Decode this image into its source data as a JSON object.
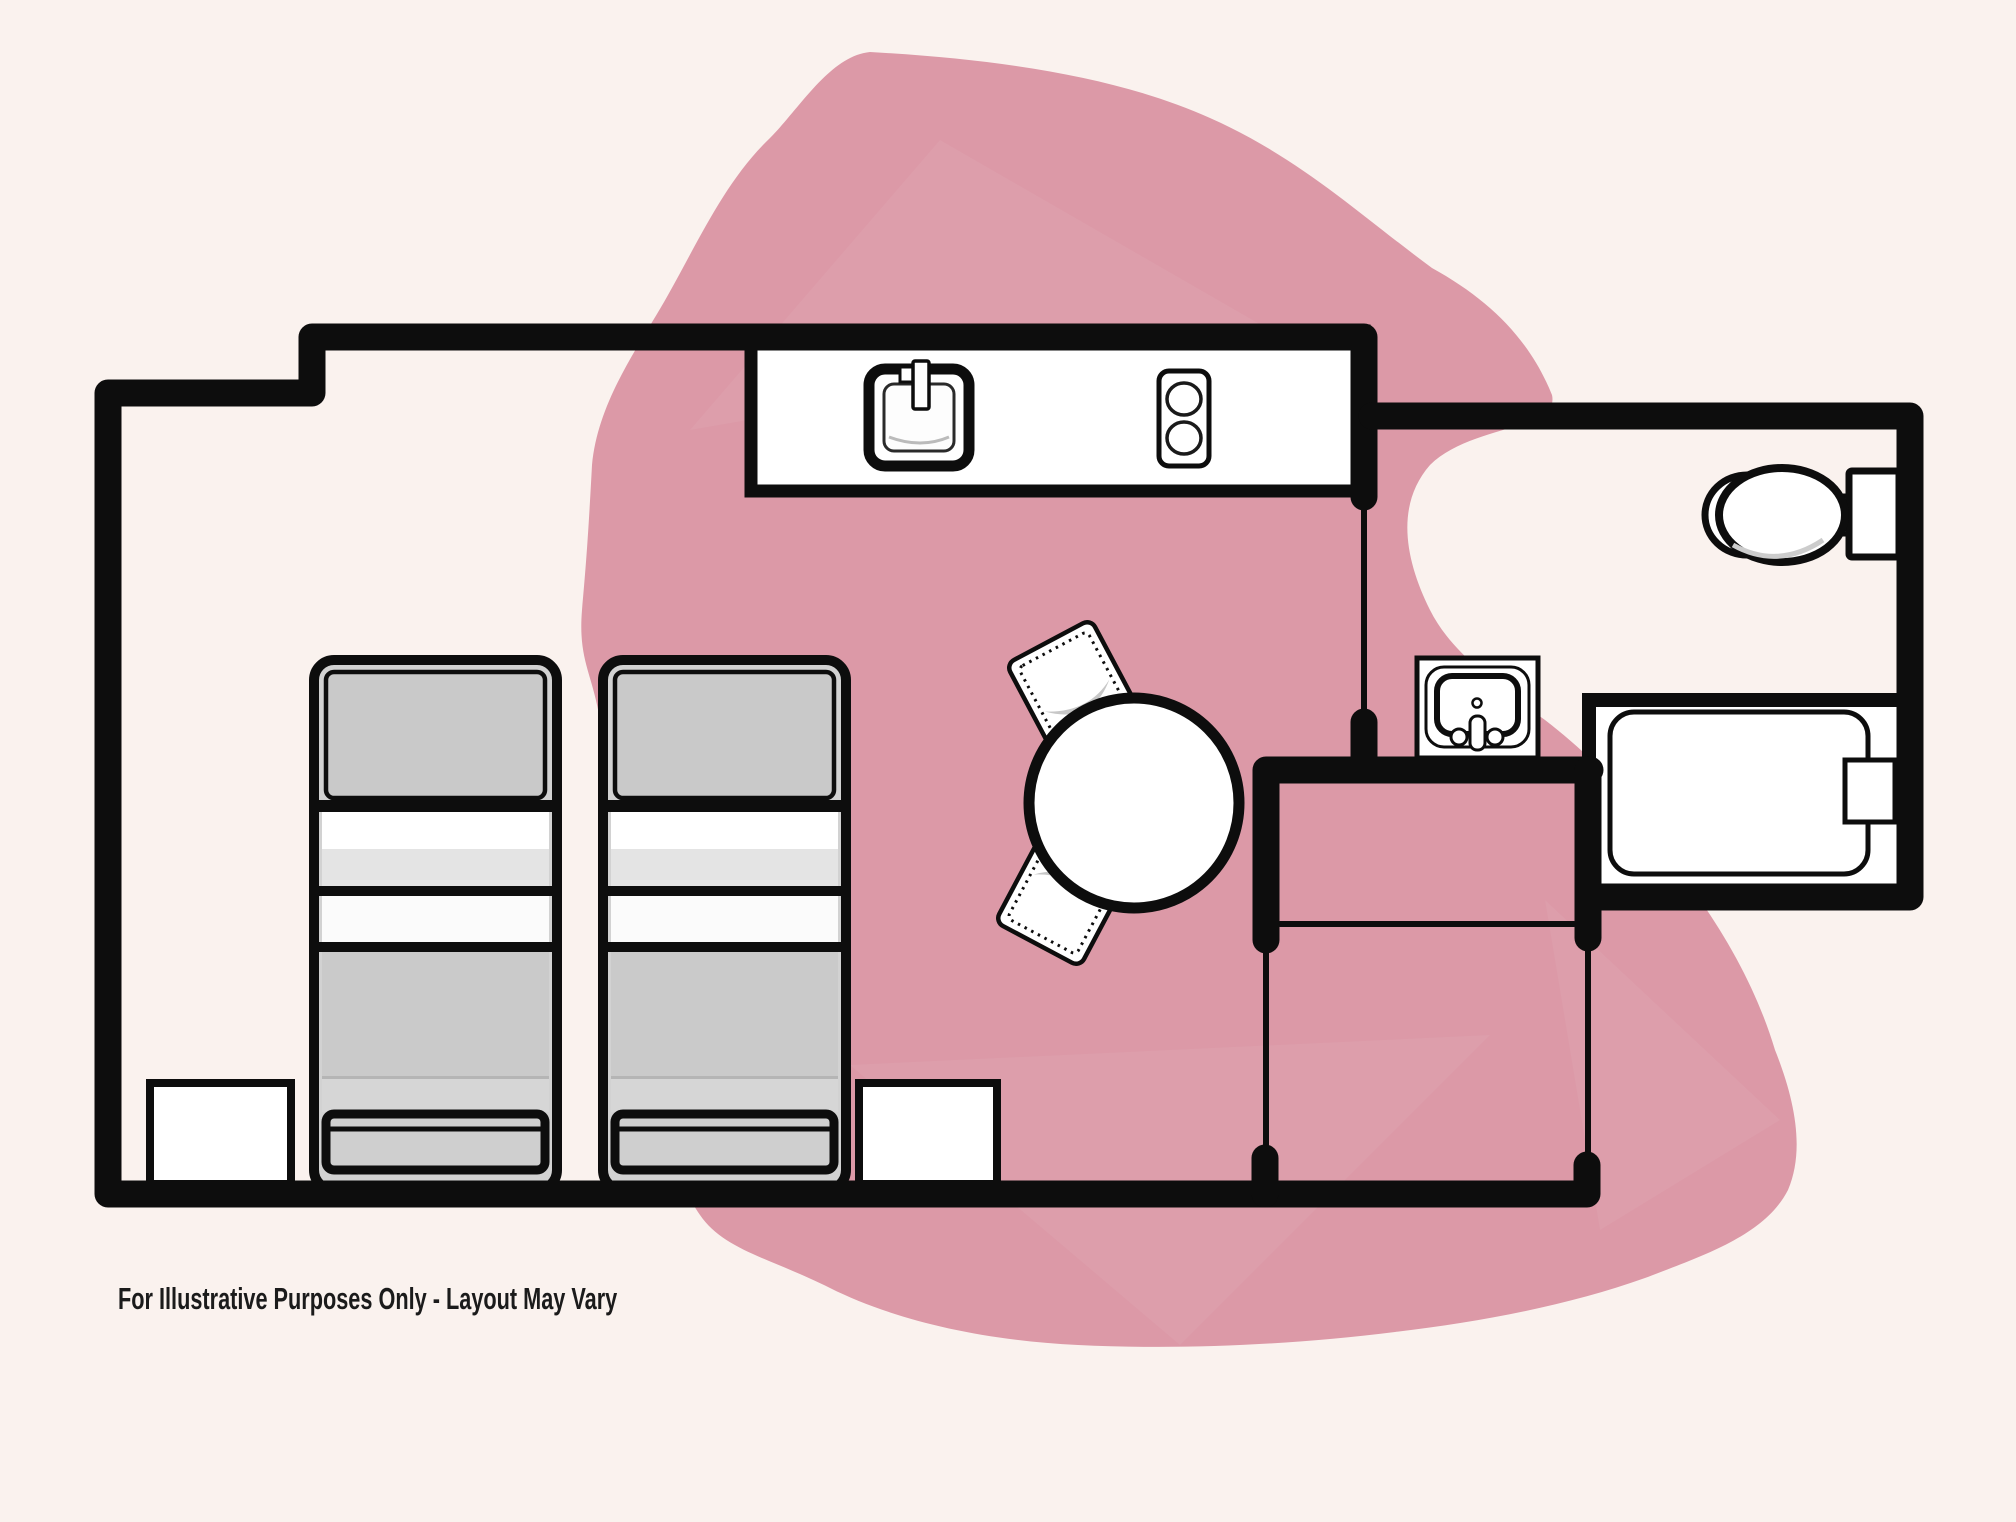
{
  "canvas": {
    "width": 2016,
    "height": 1522
  },
  "colors": {
    "background": "#faf2ee",
    "blob": "#dc99a7",
    "wall": "#0d0d0d",
    "furniture_white": "#ffffff",
    "furniture_gray": "#cbcbcb",
    "caption": "#1b1b1b"
  },
  "caption": {
    "text": "For Illustrative Purposes Only - Layout May Vary"
  },
  "floorplan": {
    "items": [
      "twin-bed",
      "twin-bed",
      "nightstand",
      "nightstand",
      "kitchen-counter",
      "kitchen-sink",
      "stove-2-burner",
      "dining-table",
      "dining-chair",
      "dining-chair",
      "toilet",
      "vanity-sink",
      "bathtub"
    ],
    "rooms": [
      "studio-main-room",
      "bathroom",
      "dressing-hall",
      "closet"
    ]
  }
}
